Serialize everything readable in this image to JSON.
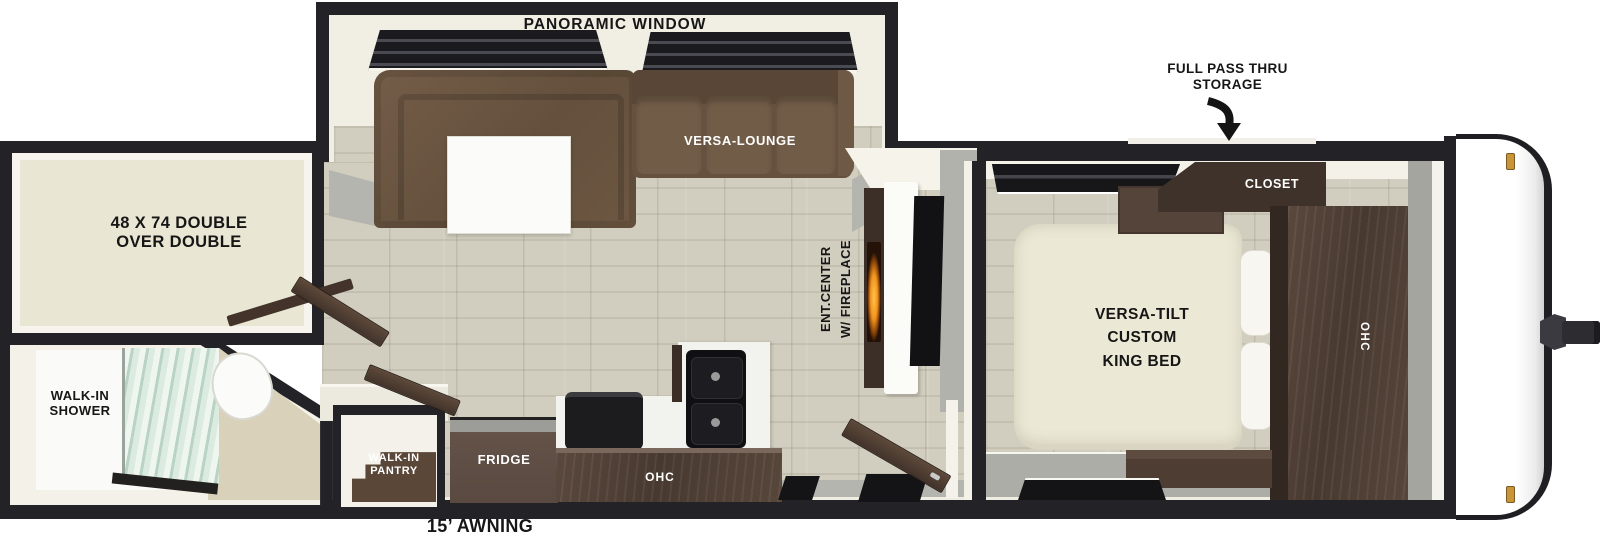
{
  "floorplan": {
    "slideout": {
      "window_label": "PANORAMIC WINDOW",
      "lounge_label": "VERSA-LOUNGE"
    },
    "storage_callout": {
      "line1": "FULL PASS THRU",
      "line2": "STORAGE"
    },
    "bunk_room": {
      "line1": "48 X 74 DOUBLE",
      "line2": "OVER DOUBLE"
    },
    "bathroom": {
      "shower_line1": "WALK-IN",
      "shower_line2": "SHOWER"
    },
    "pantry": {
      "line1": "WALK-IN",
      "line2": "PANTRY"
    },
    "kitchen": {
      "fridge_label": "FRIDGE",
      "ohc_label": "OHC"
    },
    "ent_center": {
      "line1": "ENT.CENTER",
      "line2": "W/ FIREPLACE"
    },
    "bedroom": {
      "closet_label": "CLOSET",
      "bed_line1": "VERSA-TILT",
      "bed_line2": "CUSTOM",
      "bed_line3": "KING BED",
      "ohc_label": "OHC"
    },
    "awning_label": "15’ AWNING",
    "colors": {
      "wall": "#232327",
      "floor_wood": "#d2cebf",
      "sofa_brown": "#6a5440",
      "cabinet_brown": "#483930",
      "bed_cream": "#ebe8d6",
      "flame_orange": "#f0941e",
      "gray_floor": "#adada8",
      "label_black": "#161616",
      "label_white": "#ffffff"
    }
  }
}
